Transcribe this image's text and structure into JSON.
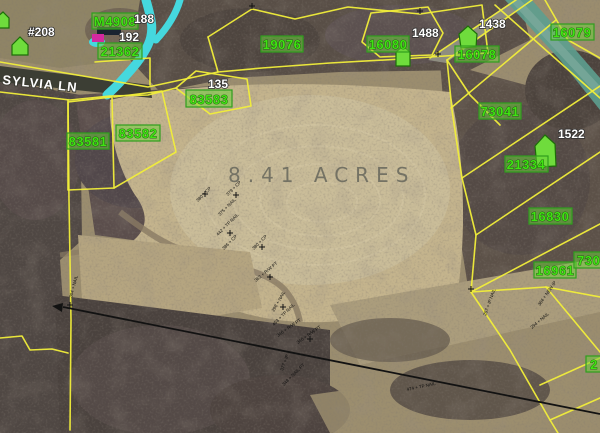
{
  "map": {
    "acreage_label": "8.41 ACRES",
    "street_label": "SYLVIA LN",
    "colors": {
      "parcel_line": "#f1ee3a",
      "parcel_label_text": "#3fe412",
      "parcel_label_bg": "#6cd43a",
      "house_marker": "#6fdc3c",
      "stream": "#45d8de",
      "survey_line": "#121212",
      "address_text": "#ffffff",
      "acreage_text": "#67675c"
    },
    "parcel_labels": [
      {
        "text": "19076"
      },
      {
        "text": "16080"
      },
      {
        "text": "16078"
      },
      {
        "text": "16079"
      },
      {
        "text": "73041"
      },
      {
        "text": "21334"
      },
      {
        "text": "16830"
      },
      {
        "text": "16961"
      },
      {
        "text": "7304"
      },
      {
        "text": "2"
      },
      {
        "text": "83581"
      },
      {
        "text": "83582"
      },
      {
        "text": "83583"
      },
      {
        "text": "21362"
      },
      {
        "text": "M4908"
      }
    ],
    "address_labels": [
      {
        "text": "#208"
      },
      {
        "text": "188"
      },
      {
        "text": "192"
      },
      {
        "text": "1488"
      },
      {
        "text": "1438"
      },
      {
        "text": "1522"
      },
      {
        "text": "135"
      }
    ],
    "survey_marks": [
      {
        "text": "380 + CP"
      },
      {
        "text": "379 + CP"
      },
      {
        "text": "375 + NAIL"
      },
      {
        "text": "442 + TP NAIL"
      },
      {
        "text": "386 + CP"
      },
      {
        "text": "380 + CP"
      },
      {
        "text": "362 + R/W PT"
      },
      {
        "text": "298 + NAIL"
      },
      {
        "text": "453 + TP NAIL"
      },
      {
        "text": "346 + R/W PT"
      },
      {
        "text": "340 + R/W PT"
      },
      {
        "text": "377 + IP"
      },
      {
        "text": "348 + NAIL PT"
      },
      {
        "text": "474 + TP NAIL"
      },
      {
        "text": "257 + IP NAIL"
      },
      {
        "text": "294 + NAIL"
      },
      {
        "text": "304 + NAIL"
      },
      {
        "text": "364 + NEW IP"
      }
    ]
  }
}
